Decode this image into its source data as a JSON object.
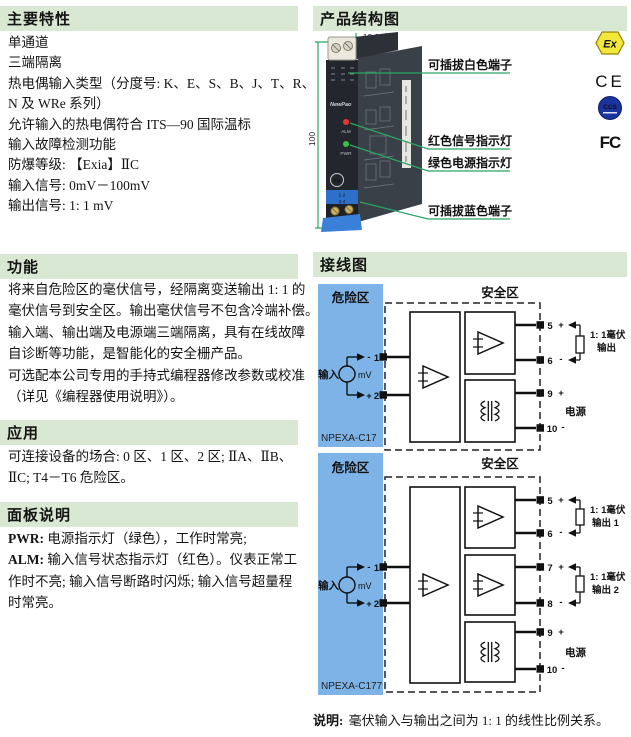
{
  "colors": {
    "header-bg": "#d9e8d2",
    "accent-green": "#2ba566",
    "hazard-blue": "#7db3e6",
    "device-dark": "#23272d",
    "device-side": "#3a4047",
    "terminal-blue": "#2e6fc9",
    "led-red": "#e8392e",
    "led-green": "#35c23d",
    "ex-yellow": "#f2e73c",
    "ccs-blue": "#1a339e",
    "ink": "#141414"
  },
  "left": {
    "features": {
      "title": "主要特性",
      "lines": [
        "单通道",
        "三端隔离",
        "热电偶输入类型（分度号: K、E、S、B、J、T、R、",
        "N 及 WRe 系列）",
        "允许输入的热电偶符合 ITS—90 国际温标",
        "输入故障检测功能",
        "防爆等级: 【Exia】ⅡC",
        "输入信号: 0mV－100mV",
        "输出信号: 1: 1 mV"
      ]
    },
    "function": {
      "title": "功能",
      "lines": [
        "将来自危险区的毫伏信号，经隔离变送输出 1: 1 的",
        "毫伏信号到安全区。输出毫伏信号不包含冷端补偿。",
        "输入端、输出端及电源端三端隔离，具有在线故障",
        "自诊断等功能，是智能化的安全栅产品。",
        "可选配本公司专用的手持式编程器修改参数或校准",
        "（详见《编程器使用说明》）。"
      ]
    },
    "application": {
      "title": "应用",
      "lines": [
        "可连接设备的场合: 0 区、1 区、2 区; ⅡA、ⅡB、",
        "ⅡC; T4－T6 危险区。"
      ]
    },
    "panel": {
      "title": "面板说明",
      "lines": [
        {
          "b": "PWR:",
          "t": " 电源指示灯（绿色），工作时常亮;"
        },
        {
          "b": "ALM:",
          "t": " 输入信号状态指示灯（红色）。仪表正常工"
        },
        {
          "b": "",
          "t": "作时不亮; 输入信号断路时闪烁; 输入信号超量程"
        },
        {
          "b": "",
          "t": "时常亮。"
        }
      ]
    }
  },
  "right": {
    "structure": {
      "title": "产品结构图",
      "dim_width": "12.8",
      "dim_height": "100",
      "brand": "NewPao",
      "led_alarm": "ALM",
      "led_power": "PWR",
      "ex_logo": "Ex",
      "terminal_rows": [
        "1 2",
        "3 4"
      ],
      "labels": {
        "white_terminal": "可插拔白色端子",
        "red_led": "红色信号指示灯",
        "green_led": "绿色电源指示灯",
        "blue_terminal": "可插拔蓝色端子"
      },
      "certs": {
        "ex": "Ex",
        "ce": "CE",
        "ccs": "CCS",
        "fcc": "FC"
      }
    },
    "wiring": {
      "title": "接线图",
      "d1": {
        "model": "NPEXA-C17",
        "hazard": "危险区",
        "safe": "安全区",
        "input": "输入",
        "unit": "mV",
        "t1": "1",
        "t1s": "-",
        "t2": "2",
        "t2s": "+",
        "t5": "5",
        "t5s": "+",
        "t6": "6",
        "t6s": "-",
        "t9": "9",
        "t9s": "+",
        "t10": "10",
        "t10s": "-",
        "out_line1": "1: 1毫伏",
        "out_line2": "输出",
        "power": "电源"
      },
      "d2": {
        "model": "NPEXA-C177",
        "hazard": "危险区",
        "safe": "安全区",
        "input": "输入",
        "unit": "mV",
        "t1": "1",
        "t1s": "-",
        "t2": "2",
        "t2s": "+",
        "t5": "5",
        "t5s": "+",
        "t6": "6",
        "t6s": "-",
        "t7": "7",
        "t7s": "+",
        "t8": "8",
        "t8s": "-",
        "t9": "9",
        "t9s": "+",
        "t10": "10",
        "t10s": "-",
        "out1_line1": "1: 1毫伏",
        "out1_line2": "输出 1",
        "out2_line1": "1: 1毫伏",
        "out2_line2": "输出 2",
        "power": "电源"
      },
      "note_label": "说明:",
      "note_text": " 毫伏输入与输出之间为 1: 1 的线性比例关系。"
    }
  }
}
